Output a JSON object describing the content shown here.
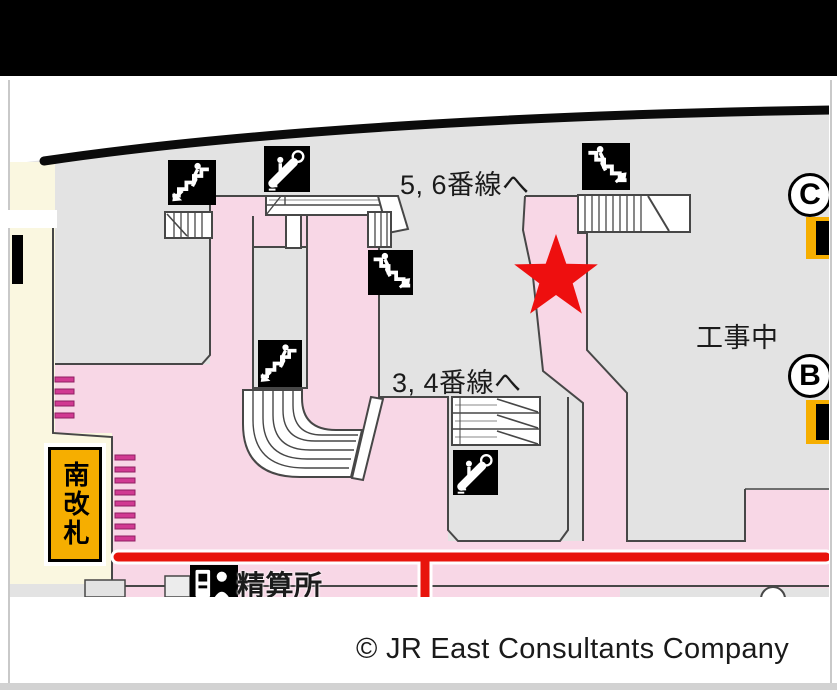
{
  "banner": {
    "color": "#000000"
  },
  "map": {
    "labels": {
      "to_platforms_5_6": "5, 6番線へ",
      "to_platforms_3_4": "3, 4番線へ",
      "under_construction": "工事中",
      "south_gate": "南改札",
      "fare_adjustment_office": "精算所"
    },
    "exit_badges": {
      "c": "C",
      "b": "B"
    },
    "marker": {
      "type": "star",
      "meaning": "current-location",
      "color": "#EE0F0F"
    },
    "icons": [
      "stairs-down-left-icon",
      "escalator-icon",
      "stairs-up-right-icon",
      "stairs-down-left-icon",
      "stairs-up-right-icon",
      "escalator-icon",
      "fare-machine-icon",
      "elevator-icon",
      "elevator-icon"
    ],
    "colors": {
      "floor": "#E3E3E3",
      "route": "#F8D7E6",
      "outside_area": "#FAF7E0",
      "gate_sign": "#F6AE00",
      "ticket_gate_bar": "#D13A92",
      "guide_line_red": "#E8140C",
      "star_red": "#EE0F0F",
      "wall": "#0B0B0B"
    }
  },
  "footer": {
    "copyright": "© JR East Consultants Company"
  }
}
